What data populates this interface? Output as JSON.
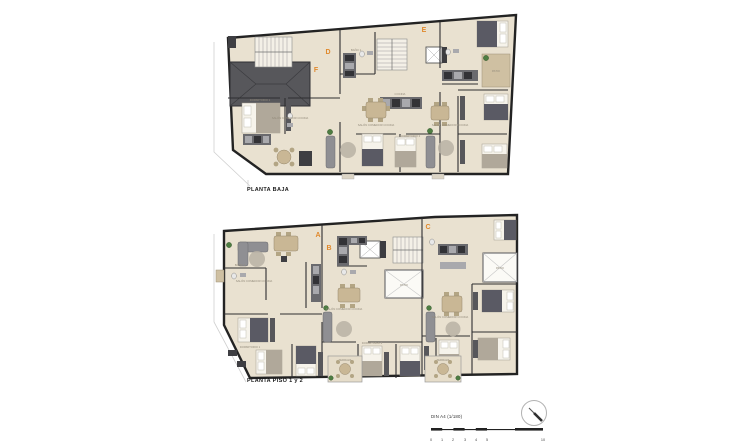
{
  "plans": [
    {
      "title": "PLANTA BAJA",
      "units": [
        {
          "letter": "D"
        },
        {
          "letter": "E"
        },
        {
          "letter": "F"
        }
      ],
      "rooms": [
        "SALÓN COMEDOR COCINA",
        "DORMITORIO 1",
        "DORMITORIO 2",
        "BAÑO 1",
        "COCINA",
        "PATIO",
        "TERRAZA",
        "HALL"
      ]
    },
    {
      "title": "PLANTA PISO 1 y 2",
      "units": [
        {
          "letter": "A"
        },
        {
          "letter": "B"
        },
        {
          "letter": "C"
        }
      ],
      "rooms": [
        "SALÓN COMEDOR COCINA",
        "DORMITORIO 1",
        "DORMITORIO 2",
        "BAÑO 1",
        "COCINA",
        "PATIO",
        "TERRAZA",
        "HALL"
      ]
    }
  ],
  "scalebar": {
    "label": "DIN A4 (1/180)",
    "ticks": [
      "0",
      "1",
      "2",
      "3",
      "4",
      "5",
      "10"
    ]
  },
  "colors": {
    "paper": "#ffffff",
    "floor": "#e9e1d0",
    "wall": "#232323",
    "terrace": "#cfc0a2",
    "roof": "#57575b",
    "unit_letter_accent": "#e0882b",
    "plant": "#4e7d42"
  }
}
